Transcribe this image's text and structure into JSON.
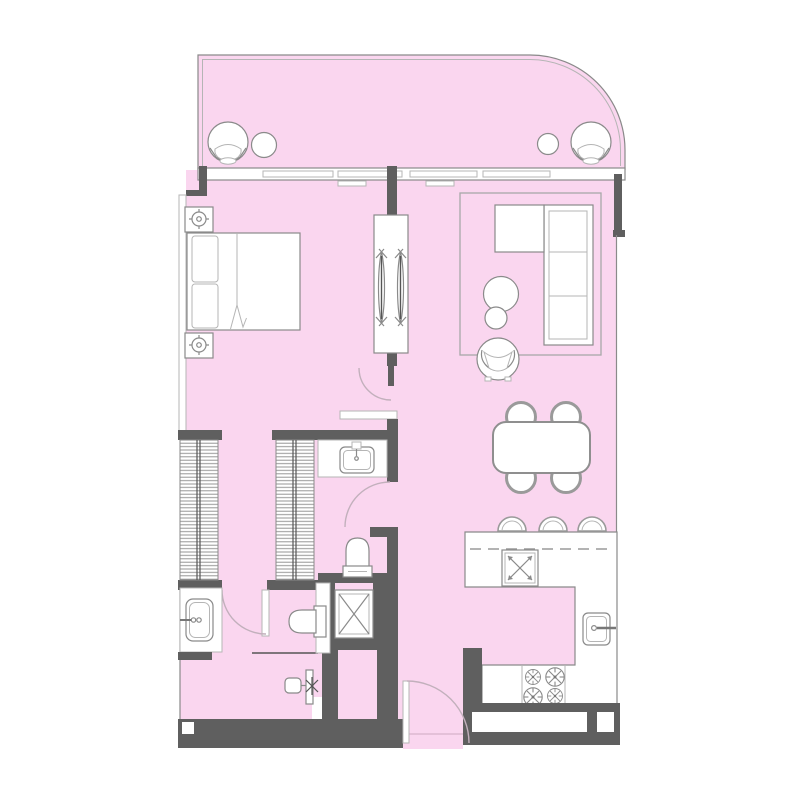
{
  "plan": {
    "type": "apartment-floor-plan",
    "style": "top-view architectural drawing, no text labels visible",
    "colors": {
      "background": "#FFFFFF",
      "floor": "#FAD6EF",
      "wall": "#5F5F5F",
      "line": "#8A8A8A",
      "line_light": "#B5B5B5",
      "furniture": "#FFFFFF",
      "arc": "#C2B0BC",
      "hatch_line": "#969696"
    },
    "rooms": [
      {
        "name": "balcony",
        "position": "top, curved right corner",
        "fixtures": [
          "lounge-chair-left",
          "side-table-left",
          "side-table-right",
          "lounge-chair-right"
        ]
      },
      {
        "name": "bedroom",
        "position": "upper-left",
        "fixtures": [
          "double-bed",
          "pillow x2",
          "nightstand x2",
          "table-lamp x2",
          "west-window-strip",
          "sliding-partition-with-louvers",
          "bedroom-door"
        ]
      },
      {
        "name": "living-area",
        "position": "upper-right",
        "fixtures": [
          "area-rug",
          "corner-sofa-with-chaise",
          "coffee-table-round",
          "nesting-table-round",
          "armchair"
        ]
      },
      {
        "name": "dining-area",
        "position": "middle-right",
        "fixtures": [
          "dining-table",
          "dining-chair x4"
        ]
      },
      {
        "name": "kitchen",
        "position": "lower-right",
        "fixtures": [
          "l-shaped-counter",
          "counter-overhang-dashed",
          "island-sink-x-symbol",
          "bar-stool x3",
          "kitchen-sink-with-faucet",
          "gas-cooktop-4-burners"
        ]
      },
      {
        "name": "bathroom",
        "position": "center",
        "fixtures": [
          "vanity-counter",
          "washbasin-with-faucet",
          "bathroom-door",
          "toilet",
          "shower-enclosure-x-symbol"
        ]
      },
      {
        "name": "walk-in-closet",
        "position": "center-left",
        "fixtures": [
          "louvered-wardrobe-left",
          "louvered-wardrobe-right",
          "closet-door"
        ]
      },
      {
        "name": "powder-room",
        "position": "bottom-left",
        "fixtures": [
          "vanity-counter",
          "basin-with-two-dot-faucet",
          "toilet-side-facing",
          "wall-hung-fixture-with-valve",
          "half-wall-line"
        ]
      },
      {
        "name": "entry-hall",
        "position": "bottom-center",
        "fixtures": [
          "entrance-door-swing",
          "service-shaft",
          "threshold"
        ]
      }
    ],
    "openings": {
      "glazed_window_wall": "full-width sliding glass panels between balcony and interior, 4 panels with center wall stub",
      "doors": [
        "entrance-door bottom center",
        "bathroom-door center right wall",
        "closet-door",
        "bedroom-hall-door"
      ]
    },
    "counts": {
      "lounge_chairs": 2,
      "bar_stools": 3,
      "dining_chairs": 4,
      "burners": 4,
      "toilets": 2,
      "sinks": 4,
      "wardrobes": 2
    }
  }
}
